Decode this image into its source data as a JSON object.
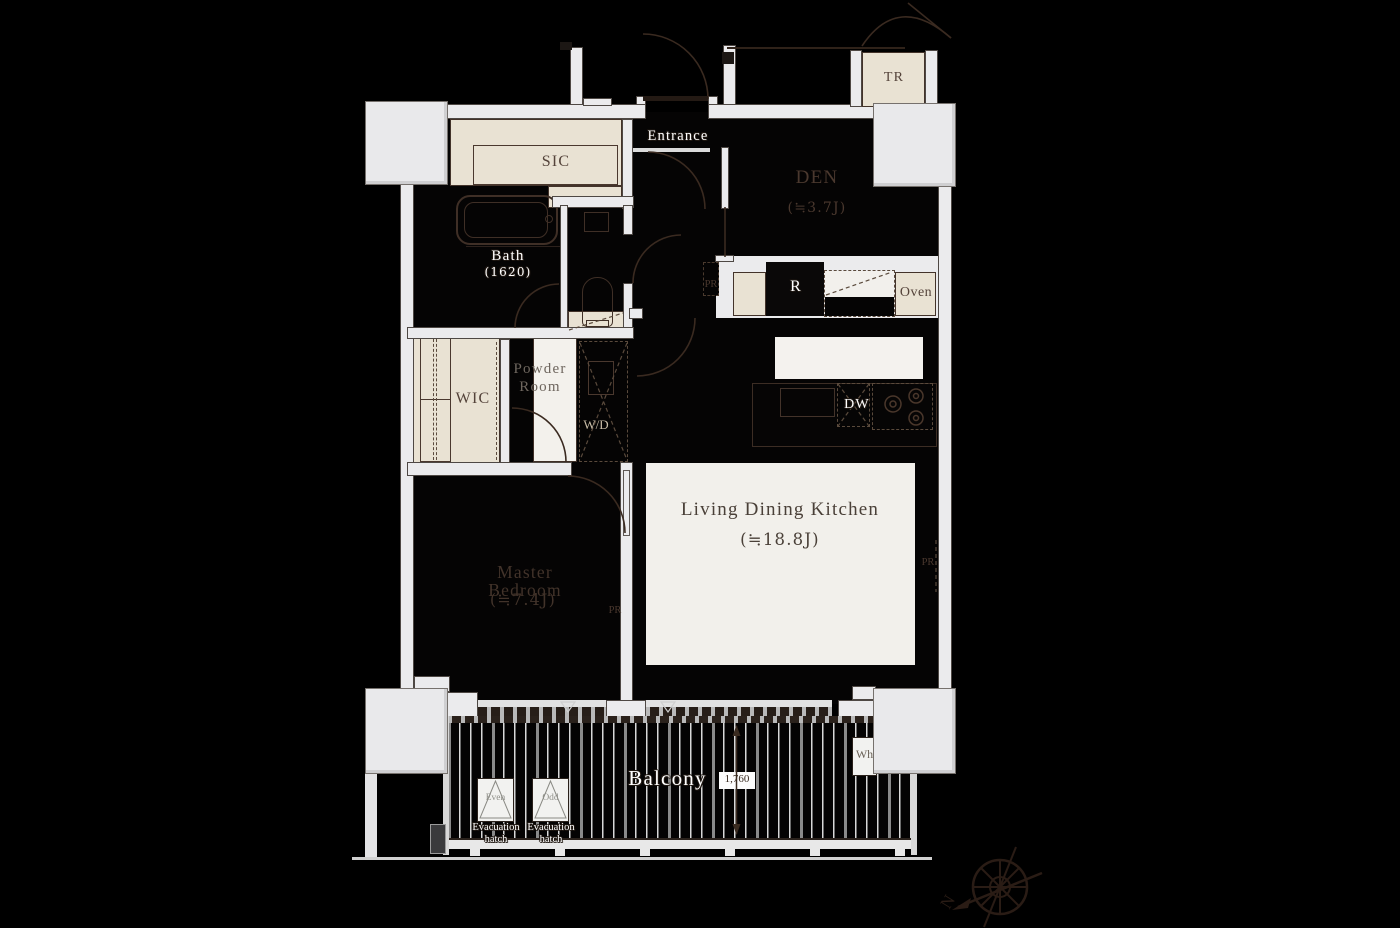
{
  "rooms": {
    "entrance": {
      "label": "Entrance"
    },
    "sic": {
      "label": "SIC"
    },
    "bath": {
      "label": "Bath",
      "size": "(1620)"
    },
    "den": {
      "label": "DEN",
      "size": "(≒3.7J)"
    },
    "powder_room": {
      "line1": "Powder",
      "line2": "Room"
    },
    "wic": {
      "label": "WIC"
    },
    "laundry": {
      "label": "W/D"
    },
    "master_bedroom": {
      "label": "Master Bedroom",
      "size": "(≒7.4J)"
    },
    "ldk": {
      "label": "Living Dining Kitchen",
      "size": "(≒18.8J)"
    },
    "balcony": {
      "label": "Balcony",
      "dimension": "1,760"
    }
  },
  "fixtures": {
    "trunk_room": "TR",
    "refrigerator": "R",
    "oven": "Oven",
    "dishwasher": "DW",
    "water_heater": "Wh",
    "pipe_shaft": "PR"
  },
  "hatches": {
    "even": {
      "label": "Even",
      "line1": "Evacuation",
      "line2": "hatch"
    },
    "odd": {
      "label": "Odd",
      "line1": "Evacuation",
      "line2": "hatch"
    }
  },
  "compass": {
    "north": "N"
  },
  "colors": {
    "background": "#000000",
    "wall": "#ebebed",
    "closet_beige": "#e9e2d3",
    "room_black": "#050404",
    "rug_white": "#f2f0eb",
    "line_brown": "#3a2a20",
    "label_white": "#ffffff",
    "label_dark": "#4a382e"
  }
}
